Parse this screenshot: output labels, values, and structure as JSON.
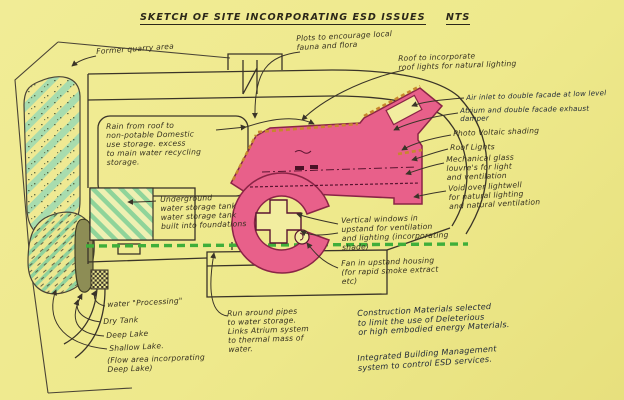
{
  "title": {
    "text": "SKETCH OF SITE INCORPORATING ESD ISSUES",
    "scale": "NTS"
  },
  "labels": {
    "former_quarry": {
      "text": "Former quarry area"
    },
    "plots": {
      "text": "Plots to encourage local\nfauna and flora"
    },
    "roof_incorporate": {
      "text": "Roof to incorporate\nroof lights for natural lighting"
    },
    "air_inlet": {
      "text": "Air inlet to double facade at low level"
    },
    "atrium_exhaust": {
      "text": "Atrium and double facade exhaust\ndamper"
    },
    "pv_shading": {
      "text": "Photo Voltaic shading"
    },
    "roof_lights": {
      "text": "Roof Lights"
    },
    "mech_louvres": {
      "text": "Mechanical glass\nlouvre's for light\nand ventilation"
    },
    "void_lightwell": {
      "text": "Void over lightwell\nfor natural lighting\nand natural ventilation"
    },
    "rain_note": {
      "text": "Rain from roof to\nnon-potable Domestic\nuse storage. excess\nto main water recycling\nstorage."
    },
    "tank_note": {
      "text": "Underground\nwater storage tank\nwater storage tank\nbuilt into foundations"
    },
    "vertical_windows": {
      "text": "Vertical windows in\nupstand for ventilation\nand lighting (incorporating\nshade)"
    },
    "fan_upstand": {
      "text": "Fan in upstand housing\n(for rapid smoke extract\netc)"
    },
    "water_processing": {
      "text": "water \"Processing\""
    },
    "dry_tank": {
      "text": "Dry Tank"
    },
    "deep_lake": {
      "text": "Deep Lake"
    },
    "shallow_lake": {
      "text": "Shallow Lake."
    },
    "flow_area": {
      "text": "(Flow area incorporating\nDeep Lake)"
    },
    "run_around": {
      "text": "Run around pipes\nto water storage.\nLinks Atrium system\nto thermal mass of\nwater."
    },
    "construction": {
      "text": "Construction Materials selected\nto limit the use of Deleterious\nor high embodied energy Materials."
    },
    "ibms": {
      "text": "Integrated Building Management\nsystem to control ESD services."
    }
  },
  "colors": {
    "paper": "#eee98c",
    "ink": "#35301f",
    "ink_blue": "#222b38",
    "atrium_pink": "#e8608a",
    "atrium_outline": "#8a2446",
    "vegetation_green": "#9fd8a4",
    "service_dash_green": "#3fae3a",
    "roof_edge_orange": "#c8862e",
    "olive_tank": "#8d8d55"
  }
}
